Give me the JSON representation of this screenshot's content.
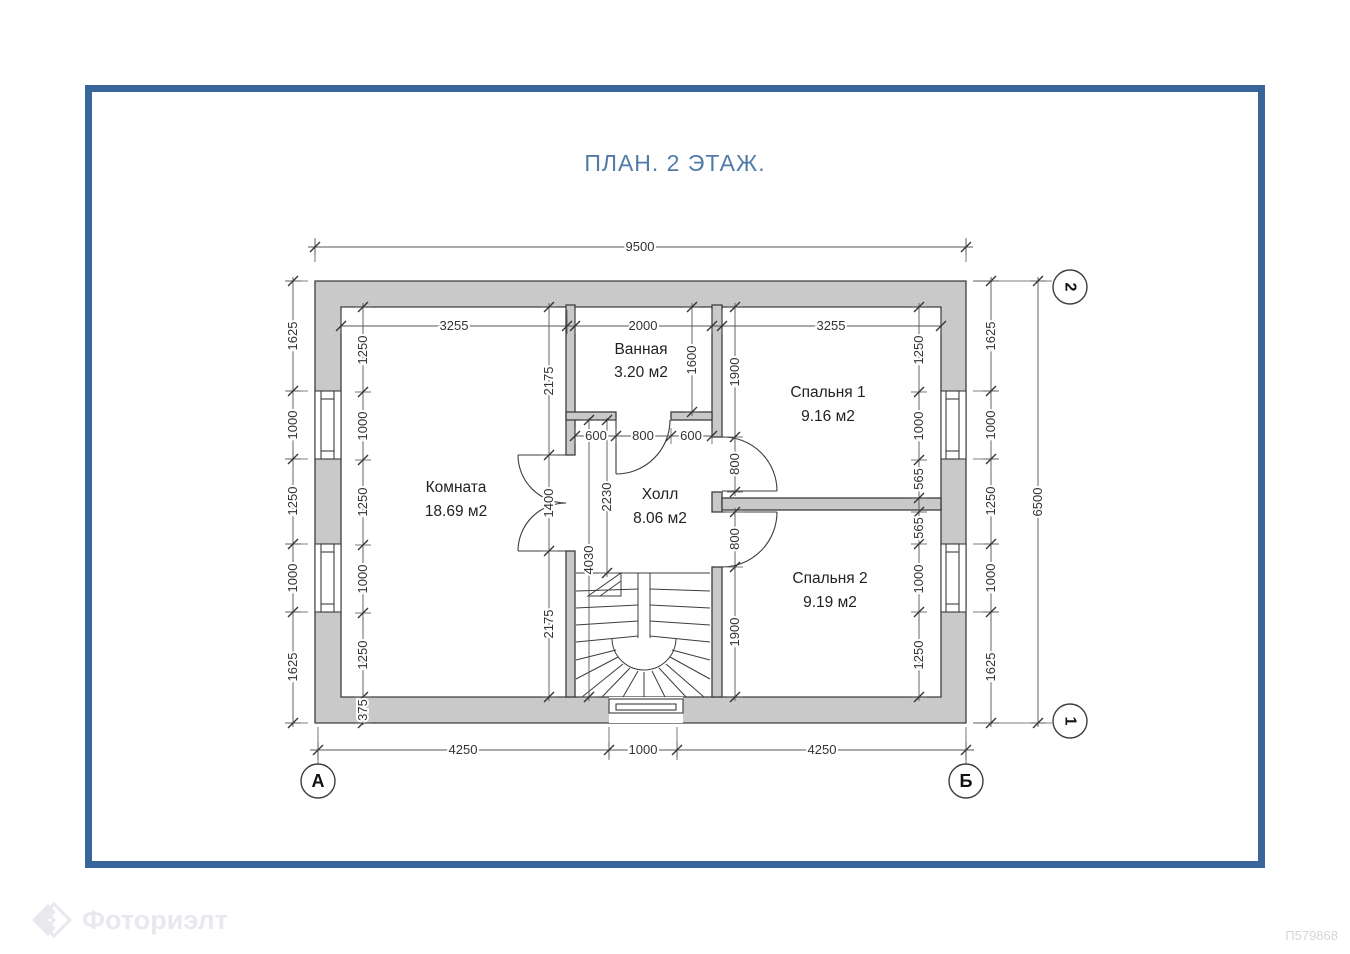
{
  "title": "ПЛАН. 2 ЭТАЖ.",
  "watermark": {
    "brand": "Фоториэлт",
    "doc_number": "П579868"
  },
  "axis_markers": {
    "col_left": "А",
    "col_right": "Б",
    "row_bottom": "1",
    "row_top": "2"
  },
  "rooms": {
    "komnata": {
      "name": "Комната",
      "area": "18.69 м2"
    },
    "vannaya": {
      "name": "Ванная",
      "area": "3.20 м2"
    },
    "holl": {
      "name": "Холл",
      "area": "8.06 м2"
    },
    "spalnya1": {
      "name": "Спальня 1",
      "area": "9.16 м2"
    },
    "spalnya2": {
      "name": "Спальня 2",
      "area": "9.19 м2"
    }
  },
  "dims": {
    "overall_width": "9500",
    "overall_height": "6500",
    "top_inner": [
      "3255",
      "2000",
      "3255"
    ],
    "bottom": [
      "4250",
      "1000",
      "4250"
    ],
    "left_outer": [
      "1625",
      "1000",
      "1250",
      "1000",
      "1625"
    ],
    "left_inner": [
      "1250",
      "1000",
      "1250",
      "1000",
      "1250",
      "375"
    ],
    "right_outer": [
      "1625",
      "1000",
      "1250",
      "1000",
      "1625"
    ],
    "right_inner": [
      "1250",
      "1000",
      "565",
      "565",
      "1000",
      "1250"
    ],
    "room_right": [
      "2175",
      "1400",
      "2175"
    ],
    "bath_height": "1600",
    "bath_bottom": [
      "600",
      "800",
      "600"
    ],
    "hall_upper": "2230",
    "hall_full": "4030",
    "bed1_left": [
      "1900",
      "800"
    ],
    "bed2_left": [
      "800",
      "1900"
    ]
  },
  "colors": {
    "frame": "#38659a",
    "title": "#527BA7",
    "wall_fill": "#c9c9c9",
    "line": "#3d3d3d"
  }
}
